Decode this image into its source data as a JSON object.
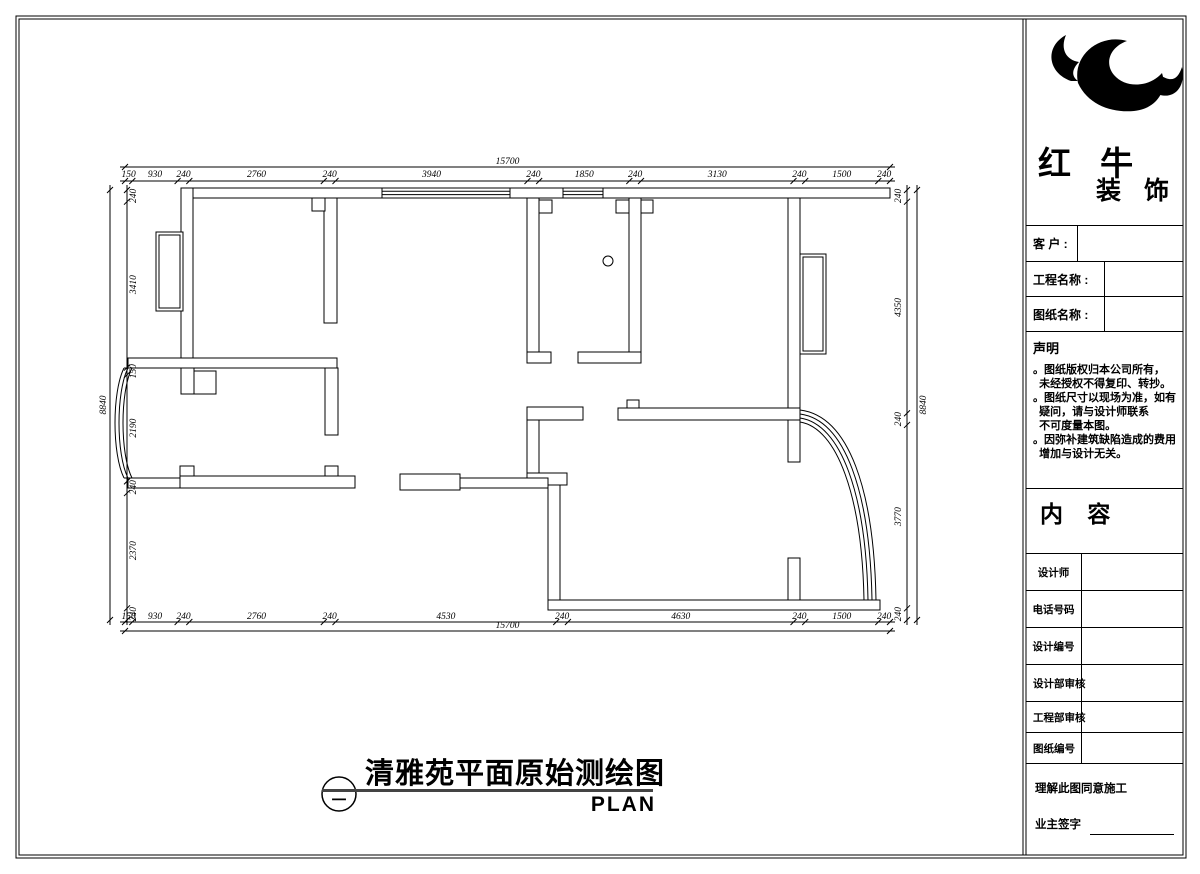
{
  "page": {
    "bg": "#ffffff",
    "line_color": "#000000"
  },
  "drawing": {
    "title": "清雅苑平面原始测绘图",
    "subtitle": "PLAN",
    "section_symbol": "二",
    "dimensions": {
      "top_total": "15700",
      "bottom_total": "15700",
      "left_total": "8840",
      "right_total": "8840",
      "top": [
        "150",
        "930",
        "240",
        "2760",
        "240",
        "3940",
        "240",
        "1850",
        "240",
        "3130",
        "240",
        "1500",
        "240"
      ],
      "bottom": [
        "150",
        "930",
        "240",
        "2760",
        "240",
        "4530",
        "240",
        "4630",
        "240",
        "1500",
        "240"
      ],
      "left": [
        "240",
        "3410",
        "150",
        "2190",
        "240",
        "2370",
        "240"
      ],
      "right": [
        "240",
        "4350",
        "240",
        "3770",
        "240"
      ]
    }
  },
  "title_block": {
    "logo": {
      "icon": "bull-swoosh",
      "brand_line1": "红 牛",
      "brand_line2": "装 饰"
    },
    "fields": [
      {
        "label": "客  户 :"
      },
      {
        "label": "工程名称 :"
      },
      {
        "label": "图纸名称 :"
      }
    ],
    "statement": {
      "title": "声明",
      "lines": [
        "。图纸版权归本公司所有，",
        "  未经授权不得复印、转抄。",
        "。图纸尺寸以现场为准，如有",
        "  疑问，请与设计师联系",
        "  不可度量本图。",
        "。因弥补建筑缺陷造成的费用",
        "  增加与设计无关。"
      ]
    },
    "content_label": "内 容",
    "rows": [
      "设计师",
      "电话号码",
      "设计编号",
      "设计部审核",
      "工程部审核",
      "图纸编号"
    ],
    "footer": {
      "line1": "理解此图同意施工",
      "line2": "业主签字"
    }
  }
}
